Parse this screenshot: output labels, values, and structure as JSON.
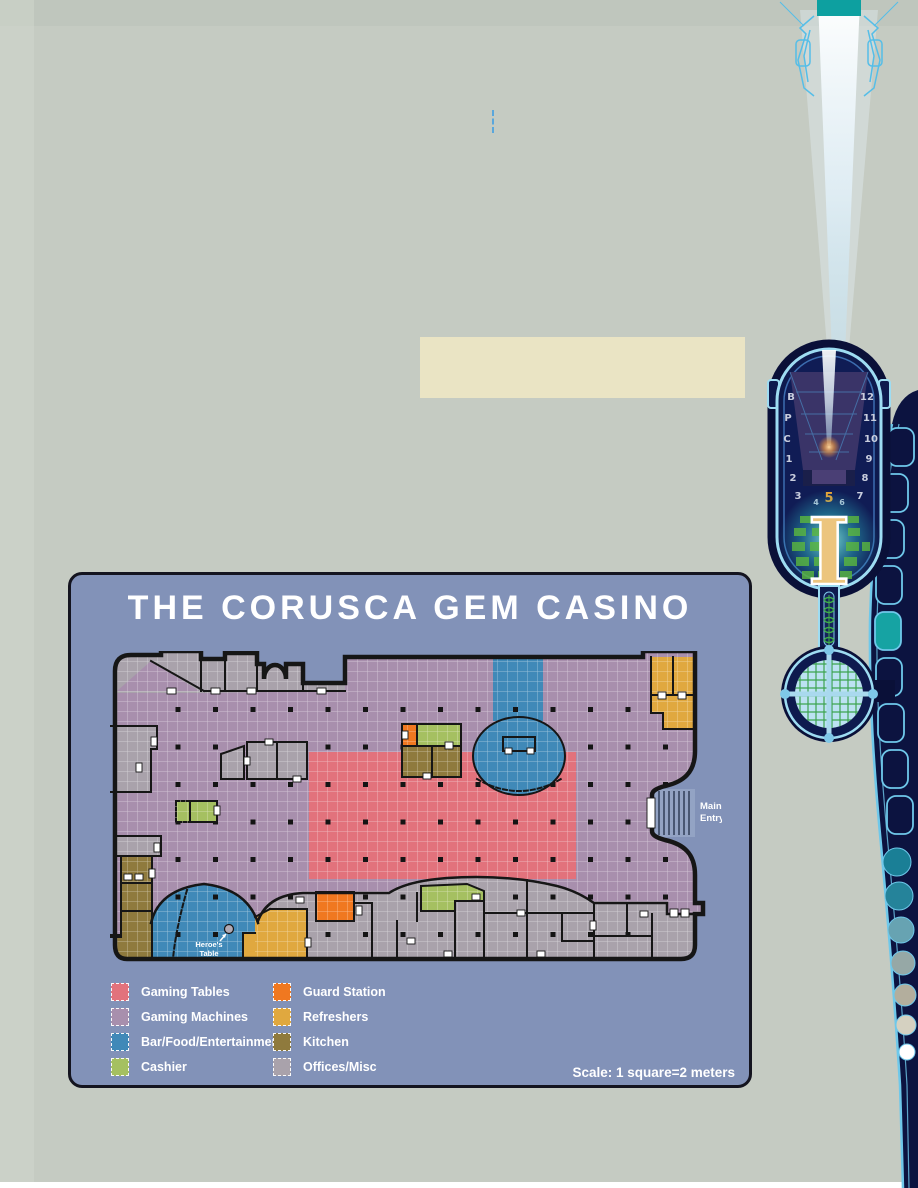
{
  "colors": {
    "page-bg": "#c5cbc2",
    "panel-bg": "#8292b8",
    "panel-border": "#14141f",
    "zone-tables": "#e2727c",
    "zone-machines": "#a88fad",
    "zone-bar": "#4089b8",
    "zone-cashier": "#a5c061",
    "zone-guard": "#f07820",
    "zone-refreshers": "#e0a83f",
    "zone-kitchen": "#8f7a3d",
    "zone-offices": "#a9a2ab",
    "wall": "#161616",
    "beige-box": "#eae4c4",
    "tower-navy": "#0c1340",
    "tower-outline": "#9edcf2",
    "tower-teal": "#0da0a0",
    "column-gold": "#ecc57e"
  },
  "map_panel": {
    "title": "THE CORUSCA GEM CASINO",
    "scale_label": "Scale: 1 square=2 meters",
    "map_labels": {
      "main_entry": [
        "Main",
        "Entry"
      ],
      "heroes_table": [
        "Heroe's",
        "Table"
      ]
    },
    "legend": {
      "items": [
        {
          "label": "Gaming Tables",
          "color_key": "zone-tables"
        },
        {
          "label": "Gaming Machines",
          "color_key": "zone-machines"
        },
        {
          "label": "Bar/Food/Entertainment",
          "color_key": "zone-bar"
        },
        {
          "label": "Cashier",
          "color_key": "zone-cashier"
        },
        {
          "label": "Guard Station",
          "color_key": "zone-guard"
        },
        {
          "label": "Refreshers",
          "color_key": "zone-refreshers"
        },
        {
          "label": "Kitchen",
          "color_key": "zone-kitchen"
        },
        {
          "label": "Offices/Misc",
          "color_key": "zone-offices"
        }
      ]
    }
  },
  "tower": {
    "floors_left": [
      "B",
      "P",
      "C",
      "1",
      "2",
      "3"
    ],
    "floors_right": [
      "12",
      "11",
      "10",
      "9",
      "8",
      "7"
    ],
    "floors_center": [
      "4",
      "5",
      "6"
    ],
    "column_label": "I"
  }
}
